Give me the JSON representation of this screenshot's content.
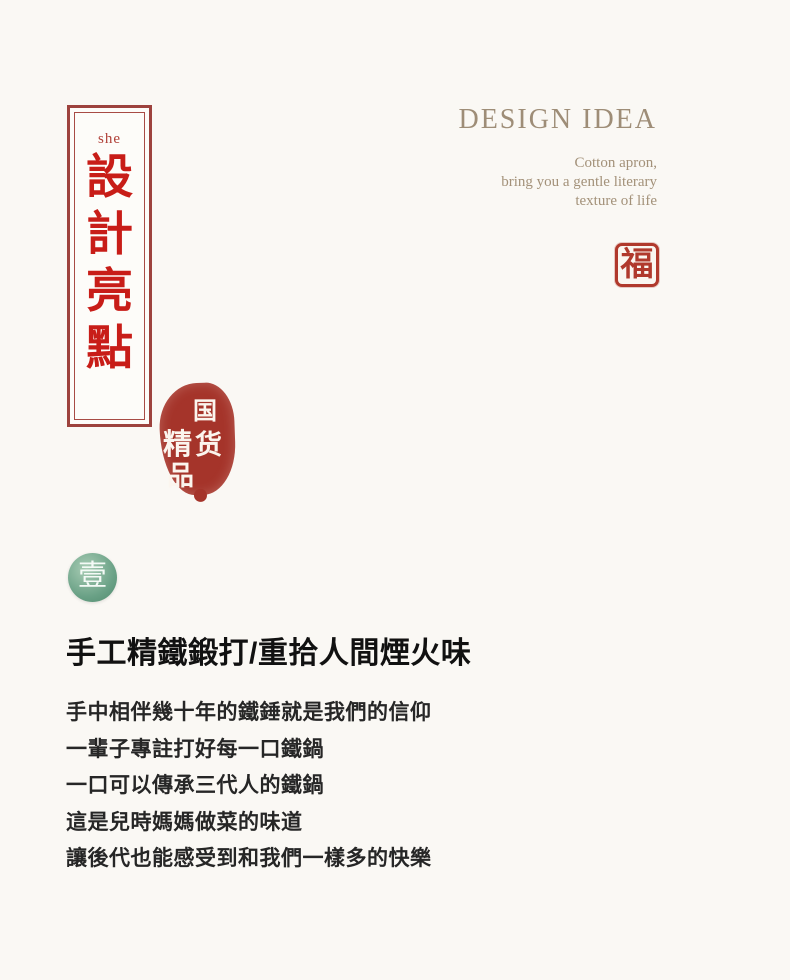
{
  "banner": {
    "pinyin": "she",
    "chars": [
      "設",
      "計",
      "亮",
      "點"
    ]
  },
  "design_idea": {
    "title": "DESIGN IDEA",
    "lines": [
      "Cotton apron,",
      "bring you a gentle literary",
      "texture of life"
    ]
  },
  "fu_seal": {
    "char": "福"
  },
  "stamp": {
    "chars": [
      "国",
      "货",
      "精",
      "品"
    ]
  },
  "section_badge": {
    "char": "壹"
  },
  "content": {
    "heading": "手工精鐵鍛打/重拾人間煙火味",
    "lines": [
      "手中相伴幾十年的鐵錘就是我們的信仰",
      "一輩子專註打好每一口鐵鍋",
      "一口可以傳承三代人的鐵鍋",
      "這是兒時媽媽做菜的味道",
      "讓後代也能感受到和我們一樣多的快樂"
    ]
  },
  "colors": {
    "background": "#faf8f4",
    "banner_text_red": "#c81d18",
    "banner_border_red": "#9d423d",
    "seal_red": "#b0392c",
    "stamp_red": "#a5342a",
    "design_idea_taupe": "#9e8d77",
    "badge_green": "#6aa186",
    "body_text": "#262626"
  }
}
